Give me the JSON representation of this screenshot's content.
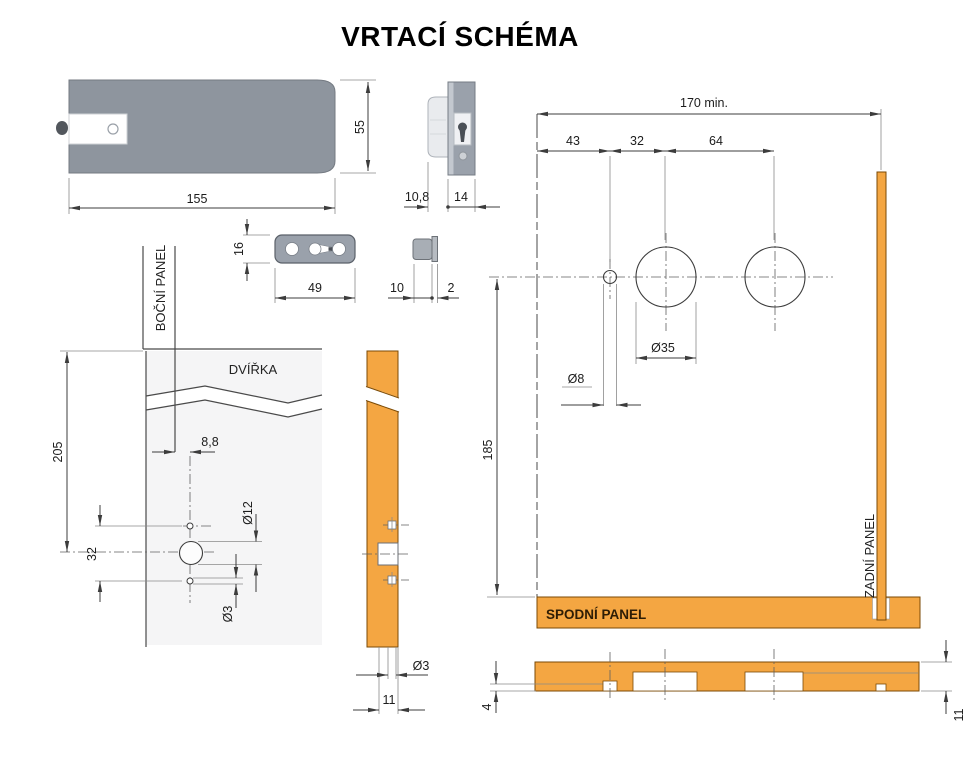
{
  "title": "VRTACÍ SCHÉMA",
  "colors": {
    "orange": "#F4A642",
    "orange_border": "#7B4A05",
    "metal_gray": "#8E959E",
    "line": "#3C3C3C"
  },
  "lock_front": {
    "width": "155",
    "height": "55"
  },
  "lock_side": {
    "protrusion": "10,8",
    "body_depth": "14"
  },
  "strike_plate": {
    "height": "16",
    "width": "49"
  },
  "bushing": {
    "length": "10",
    "flange": "2"
  },
  "door_front": {
    "side_panel_label": "BOČNÍ PANEL",
    "door_label": "DVÍŘKA",
    "edge_offset": "8,8",
    "top_to_center": "205",
    "hole_spacing": "32",
    "spindle_hole": "Ø12",
    "screw_hole": "Ø3"
  },
  "door_edge": {
    "screw_hole": "Ø3",
    "hole_offset": "11"
  },
  "drill_layout": {
    "min_width": "170 min.",
    "dim_left": "43",
    "dim_mid": "32",
    "dim_right": "64",
    "cable_hole": "Ø8",
    "cup_hole": "Ø35",
    "center_height": "185",
    "bottom_panel_label": "SPODNÍ PANEL",
    "back_panel_label": "ZADNÍ PANEL"
  },
  "bottom_edge": {
    "drill_depth": "4",
    "panel_thickness": "11"
  }
}
